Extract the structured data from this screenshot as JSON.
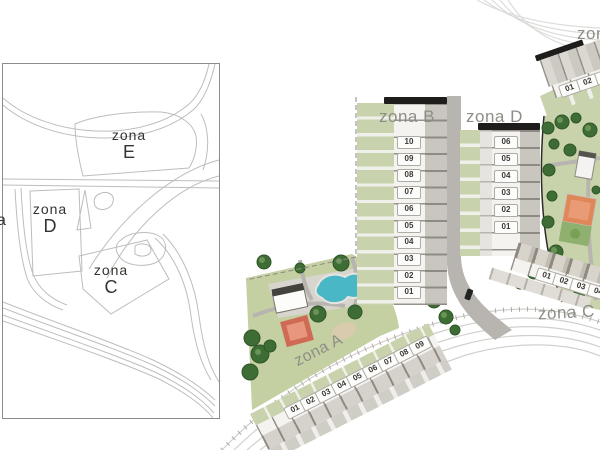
{
  "overview_map": {
    "zones": [
      {
        "id": "E",
        "word": "zona",
        "letter": "E"
      },
      {
        "id": "D",
        "word": "zona",
        "letter": "D"
      },
      {
        "id": "C",
        "word": "zona",
        "letter": "C"
      }
    ],
    "partial_label": "a"
  },
  "site_plan": {
    "zones": [
      {
        "id": "B",
        "label": "zona B",
        "units": [
          "10",
          "09",
          "08",
          "07",
          "06",
          "05",
          "04",
          "03",
          "02",
          "01"
        ]
      },
      {
        "id": "D",
        "label": "zona D",
        "units": [
          "06",
          "05",
          "04",
          "03",
          "02",
          "01"
        ]
      },
      {
        "id": "A",
        "label": "zona A",
        "units": [
          "01",
          "02",
          "03",
          "04",
          "05",
          "06",
          "07",
          "08",
          "09"
        ]
      },
      {
        "id": "C",
        "label": "zona C",
        "units": [
          "01",
          "02",
          "03",
          "04"
        ]
      },
      {
        "id": "E",
        "label": "zona E",
        "units": [
          "01",
          "02",
          "03"
        ]
      }
    ]
  },
  "colors": {
    "label_gray": "#8e8e88",
    "green_strip": "#c8d3ad",
    "lawn": "#c4cfa2",
    "pool_blue": "#49b7c6",
    "court_red": "#cf6a54",
    "court_orange": "#e0875a",
    "road_gray": "#b8b5b0",
    "roof_ridge_black": "#1e1d1b",
    "tree_green": "#3e6c35",
    "inset_line_gray": "#bdbdbd"
  }
}
